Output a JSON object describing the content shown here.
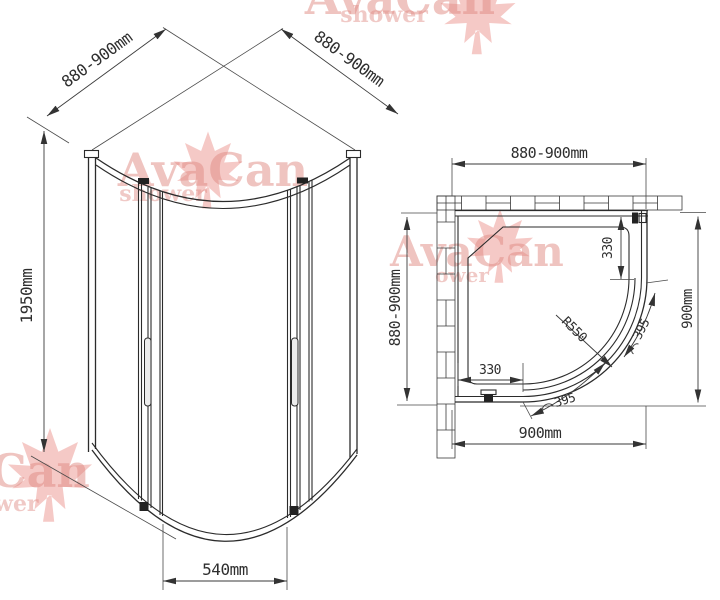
{
  "watermark": {
    "brand": "AvaCan",
    "subtitle": "shower",
    "brand_partial": "Can",
    "subtitle_partial_wer": "wer",
    "subtitle_partial_ower": "ower",
    "text_color": "#e08a83",
    "leaf_color": "#e87f76"
  },
  "front_view": {
    "top_left_width": "880-900mm",
    "top_right_width": "880-900mm",
    "height": "1950mm",
    "door_opening": "540mm"
  },
  "plan_view": {
    "top_width": "880-900mm",
    "left_depth": "880-900mm",
    "right_depth": "900mm",
    "bottom_width": "900mm",
    "right_fixed_panel": "330",
    "bottom_fixed_panel": "330",
    "door_radius": "R550",
    "door_arc_right": "395",
    "door_arc_bottom": "395"
  },
  "colors": {
    "line": "#2b2b2b",
    "background": "#ffffff"
  }
}
